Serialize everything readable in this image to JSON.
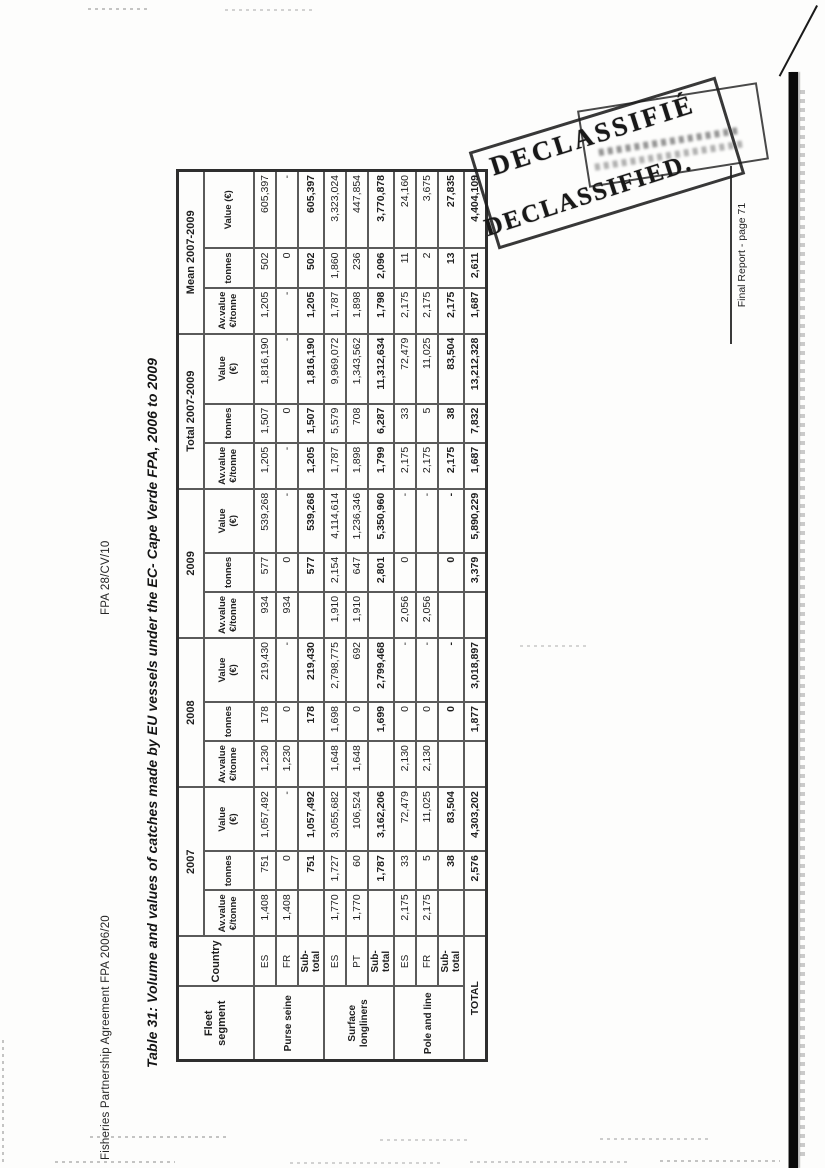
{
  "page": {
    "doc_header_left": "Fisheries Partnership Agreement FPA 2006/20",
    "doc_header_center": "FPA 28/CV/10",
    "footer": "Final Report - page 71"
  },
  "stamp": {
    "line1": "DECLASSIFIÉ",
    "line2": "DECLASSIFIED."
  },
  "colors": {
    "ink": "#1f1f1f",
    "table_border": "#5a5a5a",
    "stamp_ink": "#1c1c1c"
  },
  "table": {
    "title": "Table 31: Volume and values of catches made by EU vessels under the EC- Cape Verde FPA, 2006 to 2009",
    "header": {
      "fleet_segment": "Fleet segment",
      "country": "Country",
      "groups": [
        "2007",
        "2008",
        "2009",
        "Total 2007-2009",
        "Mean 2007-2009"
      ],
      "sub_av": "Av.value €/tonne",
      "sub_tonnes": "tonnes",
      "sub_value": "Value (€)"
    },
    "segments": [
      "Purse seine",
      "Surface longliners",
      "Pole and line"
    ],
    "total_label": "TOTAL",
    "rows": [
      {
        "country": "ES",
        "cells": [
          "1,408",
          "751",
          "1,057,492",
          "1,230",
          "178",
          "219,430",
          "934",
          "577",
          "539,268",
          "1,205",
          "1,507",
          "1,816,190",
          "1,205",
          "502",
          "605,397"
        ]
      },
      {
        "country": "FR",
        "cells": [
          "1,408",
          "0",
          "-",
          "1,230",
          "0",
          "-",
          "934",
          "0",
          "-",
          "-",
          "0",
          "-",
          "-",
          "0",
          "-"
        ]
      },
      {
        "country": "Sub-total",
        "cells": [
          "",
          "751",
          "1,057,492",
          "",
          "178",
          "219,430",
          "",
          "577",
          "539,268",
          "1,205",
          "1,507",
          "1,816,190",
          "1,205",
          "502",
          "605,397"
        ]
      },
      {
        "country": "ES",
        "cells": [
          "1,770",
          "1,727",
          "3,055,682",
          "1,648",
          "1,698",
          "2,798,775",
          "1,910",
          "2,154",
          "4,114,614",
          "1,787",
          "5,579",
          "9,969,072",
          "1,787",
          "1,860",
          "3,323,024"
        ]
      },
      {
        "country": "PT",
        "cells": [
          "1,770",
          "60",
          "106,524",
          "1,648",
          "0",
          "692",
          "1,910",
          "647",
          "1,236,346",
          "1,898",
          "708",
          "1,343,562",
          "1,898",
          "236",
          "447,854"
        ]
      },
      {
        "country": "Sub-total",
        "cells": [
          "",
          "1,787",
          "3,162,206",
          "",
          "1,699",
          "2,799,468",
          "",
          "2,801",
          "5,350,960",
          "1,799",
          "6,287",
          "11,312,634",
          "1,798",
          "2,096",
          "3,770,878"
        ]
      },
      {
        "country": "ES",
        "cells": [
          "2,175",
          "33",
          "72,479",
          "2,130",
          "0",
          "-",
          "2,056",
          "0",
          "-",
          "2,175",
          "33",
          "72,479",
          "2,175",
          "11",
          "24,160"
        ]
      },
      {
        "country": "FR",
        "cells": [
          "2,175",
          "5",
          "11,025",
          "2,130",
          "0",
          "-",
          "2,056",
          "",
          "-",
          "2,175",
          "5",
          "11,025",
          "2,175",
          "2",
          "3,675"
        ]
      },
      {
        "country": "Sub-total",
        "cells": [
          "",
          "38",
          "83,504",
          "",
          "0",
          "-",
          "",
          "0",
          "-",
          "2,175",
          "38",
          "83,504",
          "2,175",
          "13",
          "27,835"
        ]
      },
      {
        "country": "",
        "cells": [
          "",
          "2,576",
          "4,303,202",
          "",
          "1,877",
          "3,018,897",
          "",
          "3,379",
          "5,890,229",
          "1,687",
          "7,832",
          "13,212,328",
          "1,687",
          "2,611",
          "4,404,109"
        ]
      }
    ]
  }
}
